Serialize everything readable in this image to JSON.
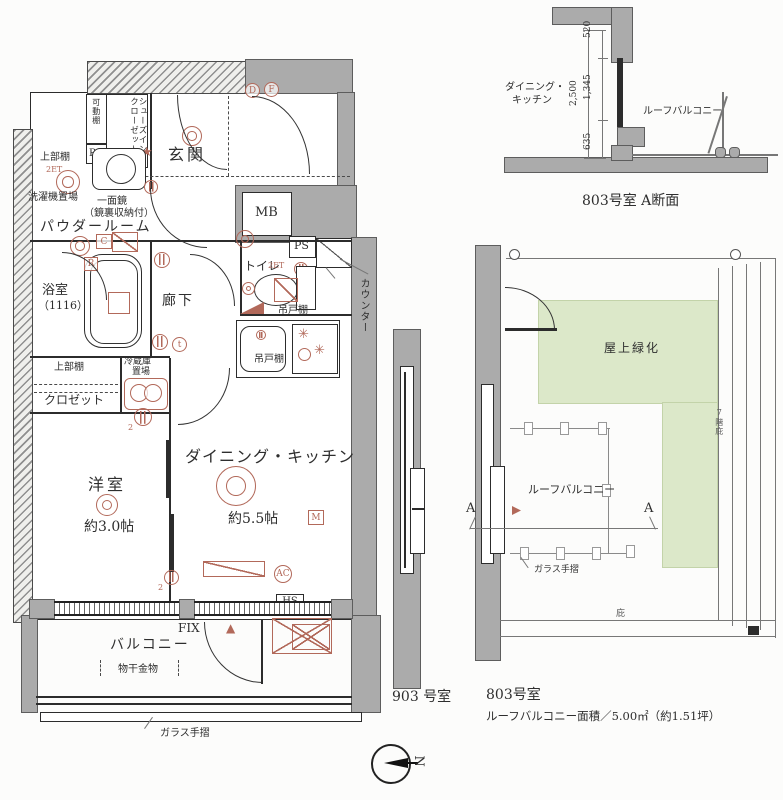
{
  "colors": {
    "wall": "#ababab",
    "annotation_red": "#b2695a",
    "roof_green": "#dce8c9"
  },
  "main": {
    "genkan": "玄関",
    "shoes1": "シューズイン",
    "shoes2": "クローゼット",
    "kadou": "可動棚",
    "ps1": "PS",
    "joubu1": "上部棚",
    "et1": "2ET",
    "sentaku": "洗濯機置場",
    "kagami1": "一面鏡",
    "kagami2": "（鏡裏収納付）",
    "powder": "パウダールーム",
    "c": "C",
    "r": "R",
    "yokushitsu": "浴室",
    "size1116": "（1116）",
    "rouka": "廊下",
    "toire": "トイレ",
    "mb": "MB",
    "ps2": "PS",
    "counter": "カウンター",
    "et2": "2ET",
    "t": "t",
    "tsuri1": "吊戸棚",
    "tsuri2": "吊戸棚",
    "reizo1": "冷蔵庫",
    "reizo2": "置場",
    "joubu2": "上部棚",
    "closet": "クロゼット",
    "yoshitsu": "洋室",
    "jo30": "約3.0帖",
    "dk": "ダイニング・キッチン",
    "jo55": "約5.5帖",
    "m": "M",
    "ac": "AC",
    "hs": "HS",
    "fix": "FIX",
    "balcony": "バルコニー",
    "monohoshi": "物干金物",
    "glass": "ガラス手摺",
    "d": "D",
    "f": "F",
    "star": "★",
    "tri": "▲",
    "two_a": "2",
    "two_b": "2"
  },
  "section": {
    "room1": "ダイニング・",
    "room2": "キッチン",
    "d520": "520",
    "d1345": "1,345",
    "d635": "635",
    "d2500": "2,500",
    "roofb": "ルーフバルコニー",
    "caption": "803号室 A断面"
  },
  "u903": {
    "caption": "903 号室"
  },
  "roof": {
    "green": "屋上緑化",
    "roofb": "ルーフバルコニー",
    "glass": "ガラス手摺",
    "a1": "A",
    "a2": "A",
    "note": "7階庇",
    "hisashi": "庇",
    "cap1": "803号室",
    "cap2": "ルーフバルコニー面積／5.00㎡（約1.51坪）"
  },
  "compass": {
    "n": "N"
  }
}
